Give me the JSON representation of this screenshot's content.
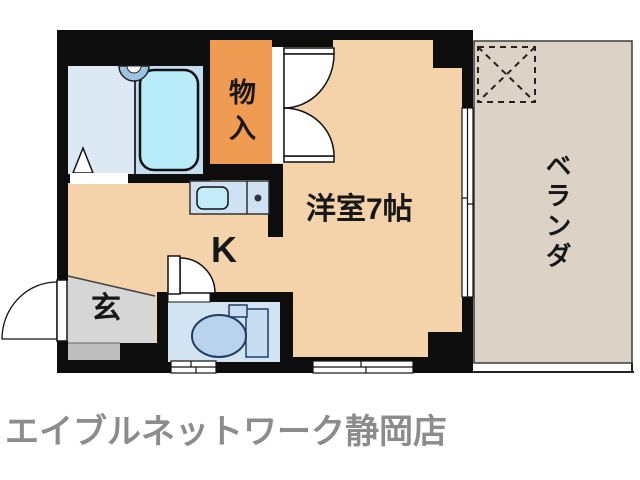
{
  "page": {
    "background": "#ffffff"
  },
  "floor_plan": {
    "labels": {
      "closet": "物入",
      "main_room": "洋室7帖",
      "kitchen": "K",
      "entrance": "玄",
      "veranda": "ベランダ"
    },
    "palette": {
      "floor": "#f4d3ab",
      "closet": "#ef9b52",
      "veranda": "#dcd2c6",
      "entrance": "#d6d6d6",
      "entrance_step": "#bdbdbd",
      "bathroom": "#dce9f5",
      "tub_section": "#c3ddee",
      "tub": "#b8ecfa",
      "shower": "#9cc4e0",
      "toilet_room": "#d2e3f2",
      "toilet_fixture": "#c6ddf2",
      "toilet_bowl": "#b9d3ec",
      "counter": "#cfe2f4",
      "sink": "#c2ecf8",
      "wall": "#0d0d0d"
    }
  },
  "footer": {
    "brand": "エイブルネットワーク静岡店",
    "color": "#8c8c8c"
  }
}
